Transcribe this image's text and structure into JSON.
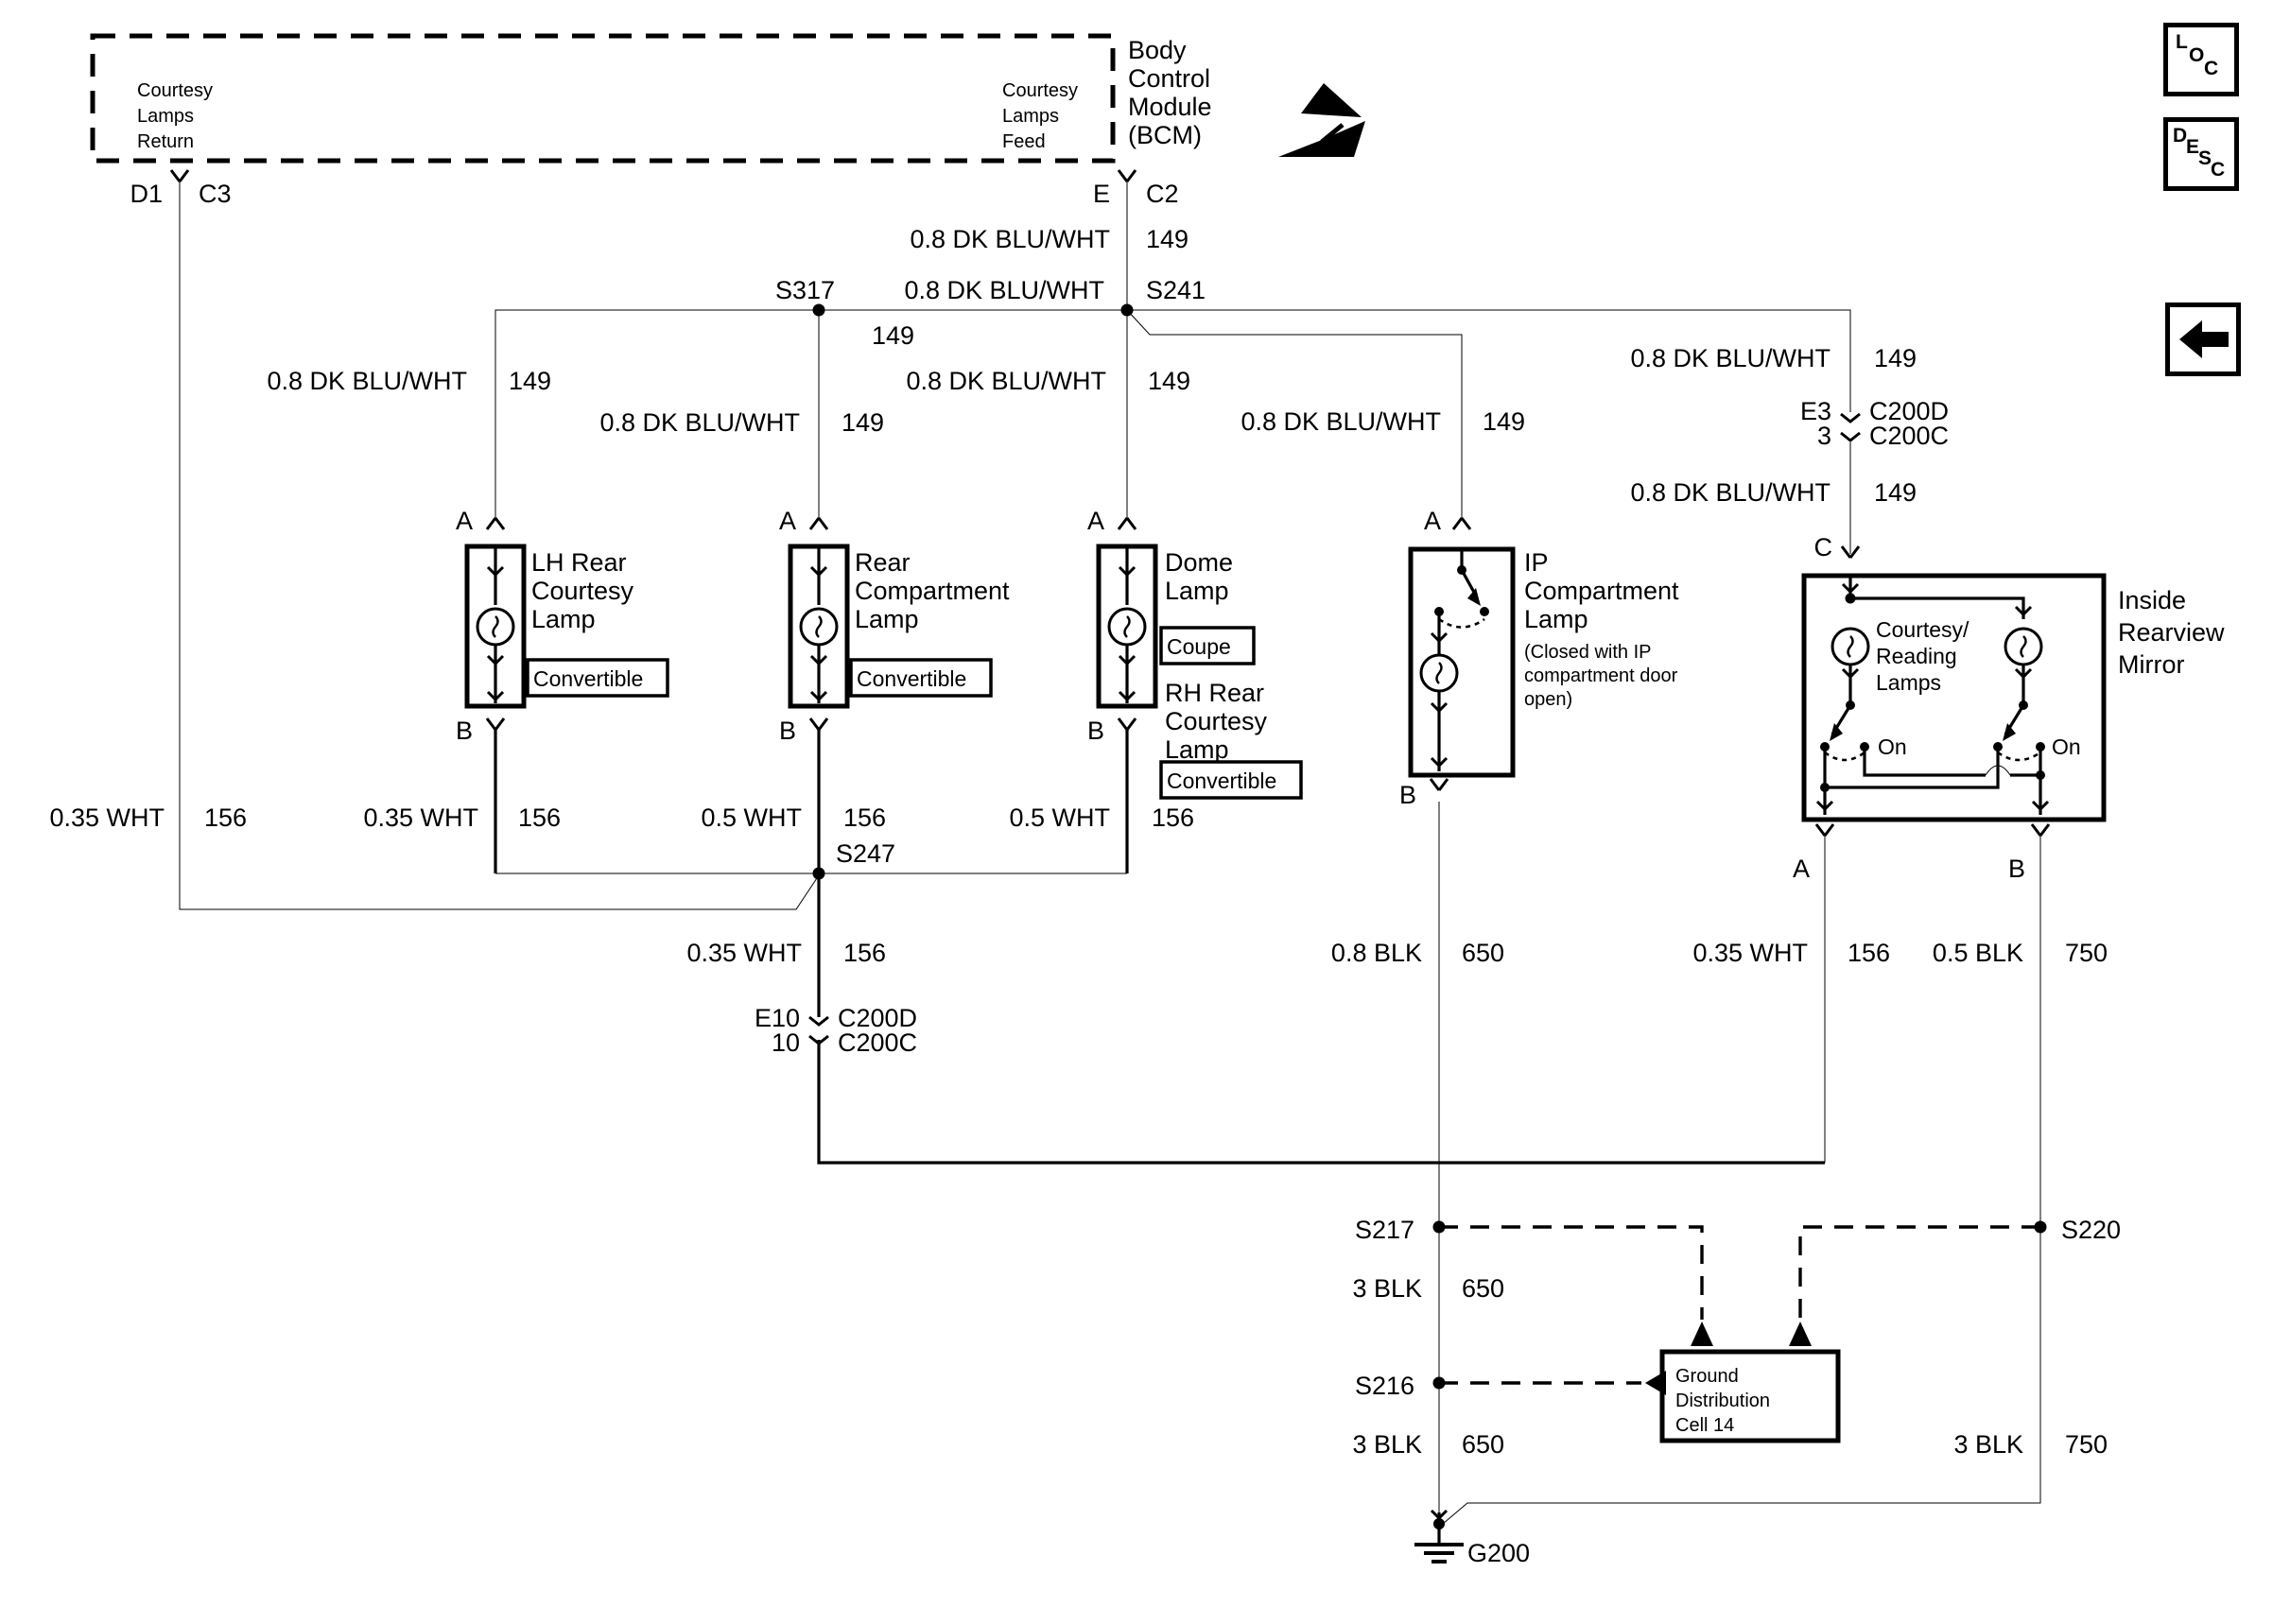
{
  "bcm": {
    "pin_return_lines": [
      "Courtesy",
      "Lamps",
      "Return"
    ],
    "pin_feed_lines": [
      "Courtesy",
      "Lamps",
      "Feed"
    ],
    "title_lines": [
      "Body",
      "Control",
      "Module",
      "(BCM)"
    ]
  },
  "buttons": {
    "loc": "LOC",
    "desc": "DESC",
    "back": "back-arrow"
  },
  "connectors": {
    "d1": "D1",
    "c3": "C3",
    "e": "E",
    "c2": "C2",
    "e3": "E3",
    "e3_top": "C200D",
    "e3_pin": "3",
    "e3_bottom": "C200C",
    "e10": "E10",
    "e10_top": "C200D",
    "e10_pin": "10",
    "e10_bottom": "C200C"
  },
  "splices": {
    "s317": "S317",
    "s241": "S241",
    "s247": "S247",
    "s217": "S217",
    "s216": "S216",
    "s220": "S220"
  },
  "ground": {
    "g200": "G200",
    "cell_lines": [
      "Ground",
      "Distribution",
      "Cell 14"
    ]
  },
  "wire_labels": [
    {
      "id": "feed",
      "name": "0.8 DK BLU/WHT",
      "circuit": "149"
    },
    {
      "id": "s317seg",
      "name": "0.8 DK BLU/WHT",
      "circuit": "149"
    },
    {
      "id": "lh",
      "name": "0.8 DK BLU/WHT",
      "circuit": "149"
    },
    {
      "id": "rc",
      "name": "0.8 DK BLU/WHT",
      "circuit": "149"
    },
    {
      "id": "dome",
      "name": "0.8 DK BLU/WHT",
      "circuit": "149"
    },
    {
      "id": "ip",
      "name": "0.8 DK BLU/WHT",
      "circuit": "149"
    },
    {
      "id": "mir_upper",
      "name": "0.8 DK BLU/WHT",
      "circuit": "149"
    },
    {
      "id": "mir_lower",
      "name": "0.8 DK BLU/WHT",
      "circuit": "149"
    },
    {
      "id": "d1_ret",
      "name": "0.35 WHT",
      "circuit": "156"
    },
    {
      "id": "lh_ret",
      "name": "0.35 WHT",
      "circuit": "156"
    },
    {
      "id": "rc_ret",
      "name": "0.5 WHT",
      "circuit": "156"
    },
    {
      "id": "dome_ret",
      "name": "0.5 WHT",
      "circuit": "156"
    },
    {
      "id": "s247_stem",
      "name": "0.35 WHT",
      "circuit": "156"
    },
    {
      "id": "mir_a_ret",
      "name": "0.35 WHT",
      "circuit": "156"
    },
    {
      "id": "ip_blk",
      "name": "0.8 BLK",
      "circuit": "650"
    },
    {
      "id": "mir_b_blk",
      "name": "0.5 BLK",
      "circuit": "750"
    },
    {
      "id": "blk650_a",
      "name": "3 BLK",
      "circuit": "650"
    },
    {
      "id": "blk650_b",
      "name": "3 BLK",
      "circuit": "650"
    },
    {
      "id": "blk750",
      "name": "3 BLK",
      "circuit": "750"
    }
  ],
  "components": {
    "lh_lines": [
      "LH Rear",
      "Courtesy",
      "Lamp"
    ],
    "lh_tag": "Convertible",
    "rc_lines": [
      "Rear",
      "Compartment",
      "Lamp"
    ],
    "rc_tag": "Convertible",
    "dome_lines": [
      "Dome",
      "Lamp"
    ],
    "dome_tag": "Coupe",
    "rh_lines": [
      "RH Rear",
      "Courtesy",
      "Lamp"
    ],
    "rh_tag": "Convertible",
    "ip_lines": [
      "IP",
      "Compartment",
      "Lamp"
    ],
    "ip_note_lines": [
      "(Closed with IP",
      "compartment door",
      "open)"
    ],
    "mirror_lines": [
      "Inside",
      "Rearview",
      "Mirror"
    ],
    "mirror_lamp_lines": [
      "Courtesy/",
      "Reading",
      "Lamps"
    ],
    "on_left": "On",
    "on_right": "On"
  },
  "terminals": {
    "lh_a": "A",
    "lh_b": "B",
    "rc_a": "A",
    "rc_b": "B",
    "dome_a": "A",
    "dome_b": "B",
    "ip_a": "A",
    "ip_b": "B",
    "mir_c": "C",
    "mir_a": "A",
    "mir_b": "B"
  }
}
